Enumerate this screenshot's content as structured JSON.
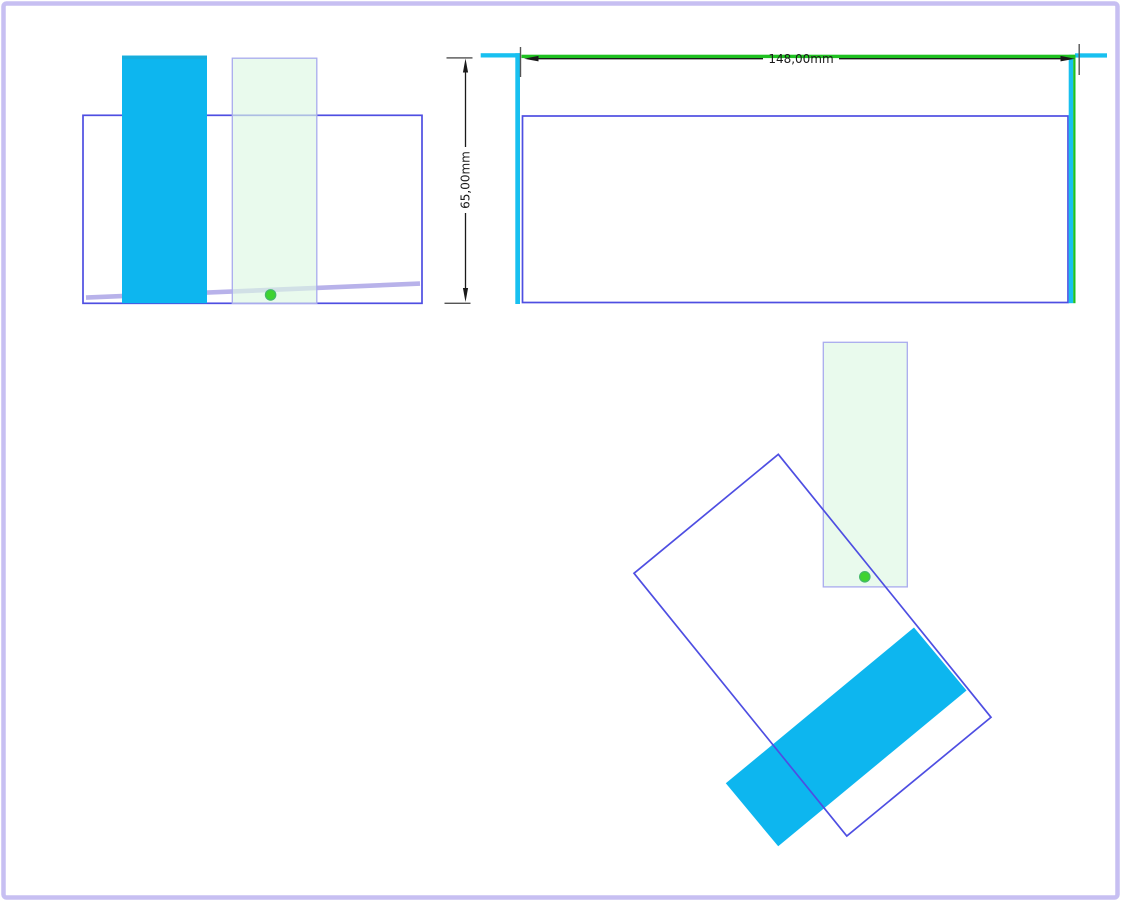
{
  "drawing": {
    "top_view": {
      "width_dimension": {
        "value": "148,00",
        "unit": "mm",
        "label": "148,00mm"
      },
      "height_dimension": {
        "value": "65,00",
        "unit": "mm",
        "label": "65,00mm"
      }
    }
  },
  "colors": {
    "cyan-fill": "#0db6ef",
    "cyan-fill-dark": "#17addc",
    "cyan-line": "#18c0f0",
    "green-line": "#1fc121",
    "blue-outline": "#4e4ee2",
    "lavender-line": "#b8b2ea",
    "pale-green-fill": "rgba(222,248,227,0.66)",
    "pale-green-stroke": "#a9abee",
    "dot-green": "#3ed331",
    "dot-stroke": "#44b86a",
    "frame-purple": "#c7bff2",
    "dim-color": "#1a1a1a",
    "tick-color": "#555555"
  }
}
